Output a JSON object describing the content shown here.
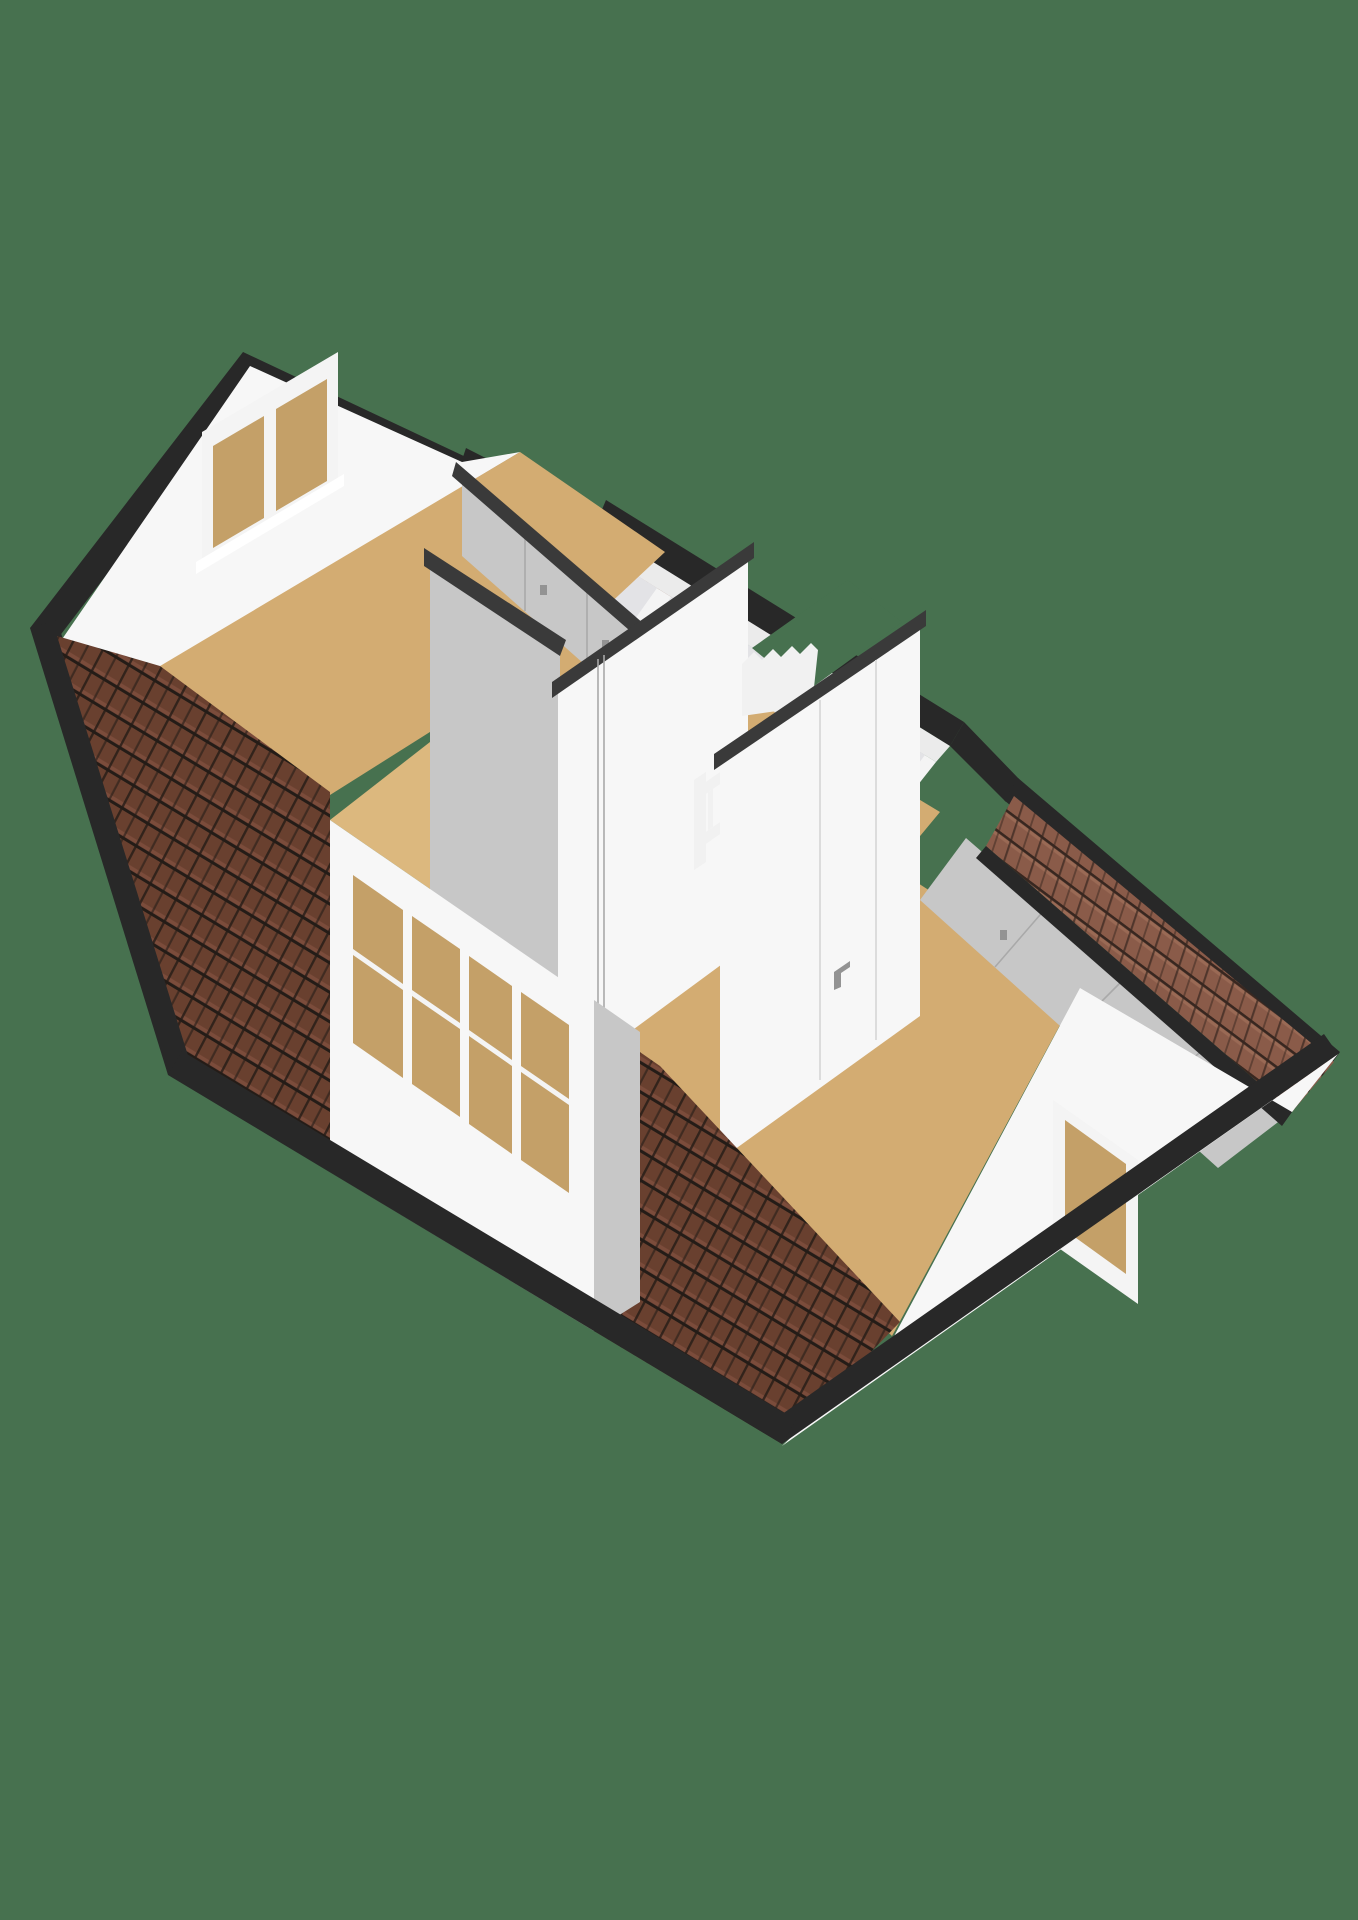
{
  "scene": {
    "kind": "3d-floorplan-render",
    "view": "axonometric-from-above",
    "storey": "attic-floor-with-sloped-roofs"
  },
  "colors": {
    "background": "#47714F",
    "fascia": "#282828",
    "cut_top": "#3a3a3a",
    "wall_white": "#f7f7f7",
    "wall_shade": "#ebebeb",
    "wall_gray": "#c7c7c7",
    "wall_gray_dark": "#b3b3b3",
    "floor_tan": "#d3ac72",
    "floor_tan_light": "#dcb87e",
    "roof_front": "#69402f",
    "roof_dark": "#241c17",
    "roof_front_hi": "#8a5645",
    "roof_back": "#8a5b49",
    "roof_back_dark": "#382720",
    "roof_back_hi": "#aa7a62",
    "glass": "#e3e3e6",
    "glass_tan": "#c4a068",
    "window_frame": "#f4f4f4",
    "railing": "#f1f1f1",
    "seam": "#a9a9a9",
    "door_line": "#dcdcdc",
    "handle": "#939393"
  },
  "structure": {
    "rooms": [
      {
        "name": "left-bedroom",
        "floor": "tan",
        "features": [
          "gable-window-2-pane",
          "built-in-closet-gray",
          "tiled-roof-slope"
        ]
      },
      {
        "name": "front-dormer-room",
        "floor": "tan",
        "features": [
          "window-band-4-pane"
        ]
      },
      {
        "name": "landing",
        "floor": "tan",
        "features": [
          "window-band-5-pane",
          "stair-opening",
          "baluster-railing"
        ]
      },
      {
        "name": "right-bedroom",
        "floor": "tan",
        "features": [
          "gable-window-1-pane",
          "built-in-closet-gray",
          "door-with-handle"
        ]
      }
    ],
    "stairs": {
      "railing_posts": 12,
      "visible_zigzag_steps": 6
    },
    "windows": {
      "left_gable_panes": 2,
      "front_dormer_panes": 4,
      "back_landing_panes": 5,
      "right_gable_panes": 1
    },
    "roof": {
      "material": "ceramic-tile",
      "front_slopes": 2,
      "back_strips": 2,
      "edge_color_name": "dark-fascia"
    }
  }
}
